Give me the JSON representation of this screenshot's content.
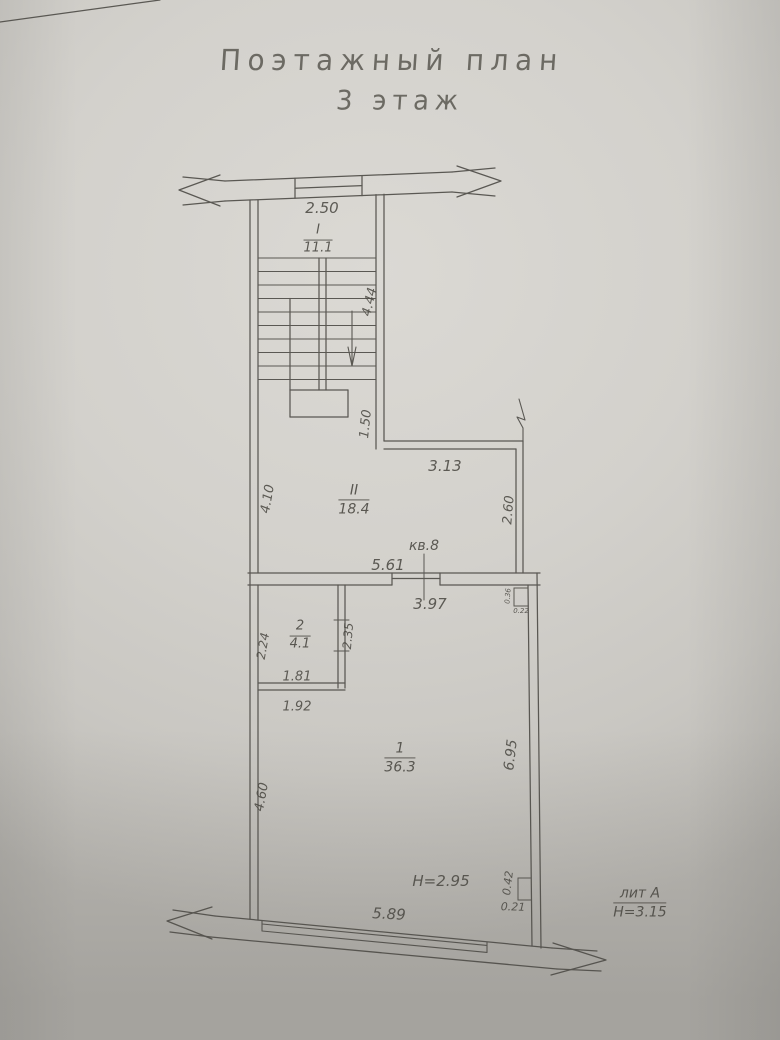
{
  "page": {
    "title_line1": "Поэтажный план",
    "title_line2": "3 этаж"
  },
  "plan": {
    "stairwell": {
      "number": "I",
      "area": "11.1",
      "dim_width": "2.50",
      "dim_flight": "4.44",
      "dim_landing": "1.50"
    },
    "corridor": {
      "number": "II",
      "area": "18.4",
      "dim_top": "3.13",
      "dim_left": "4.10",
      "dim_right": "2.60"
    },
    "apartment_label": "кв.8",
    "dim_apartment_width": "5.61",
    "room1": {
      "number": "1",
      "area": "36.3",
      "dim_top": "3.97",
      "dim_right": "6.95",
      "dim_left": "4.60",
      "dim_bottom": "5.89",
      "ceiling_height": "H=2.95"
    },
    "room2": {
      "number": "2",
      "area": "4.1",
      "dim_left": "2.24",
      "dim_right": "2.35",
      "dim_bottom_inner": "1.81",
      "dim_bottom_outer": "1.92"
    },
    "niche_top": {
      "dim_h": "0.36",
      "dim_w": "0.22"
    },
    "niche_bottom": {
      "dim_h": "0.42",
      "dim_w": "0.21"
    },
    "litera": {
      "name": "лит А",
      "building_height": "Н=3.15"
    }
  }
}
